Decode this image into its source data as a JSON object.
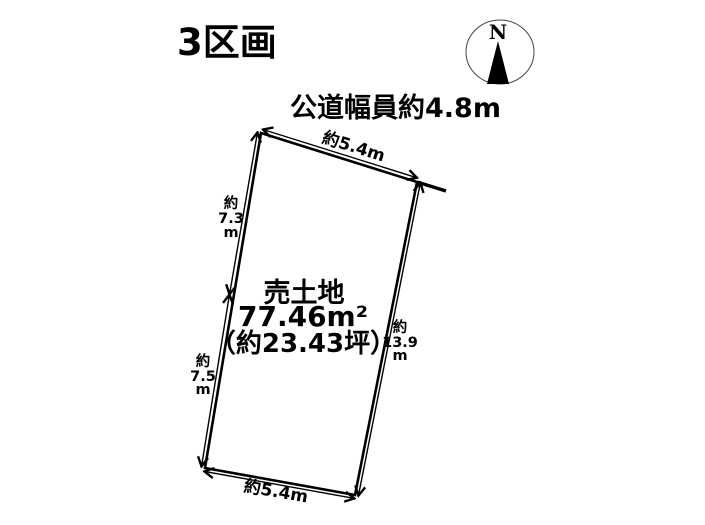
{
  "title": "3区画",
  "road_label": "公道幅員約4.8m",
  "compass": {
    "north_label": "N"
  },
  "parcel": {
    "label_lines": [
      "売土地",
      "77.46m²",
      "（約23.43坪）"
    ]
  },
  "dimensions": {
    "top_edge": "約5.4m",
    "bottom_edge": "約5.4m",
    "left_upper": {
      "lines": [
        "約",
        "7.3",
        "m"
      ]
    },
    "left_lower": {
      "lines": [
        "約",
        "7.5",
        "m"
      ]
    },
    "right": {
      "lines": [
        "約",
        "13.9",
        "m"
      ]
    }
  },
  "colors": {
    "ink": "#000000",
    "background": "#ffffff",
    "compass_ring": "#444444"
  }
}
